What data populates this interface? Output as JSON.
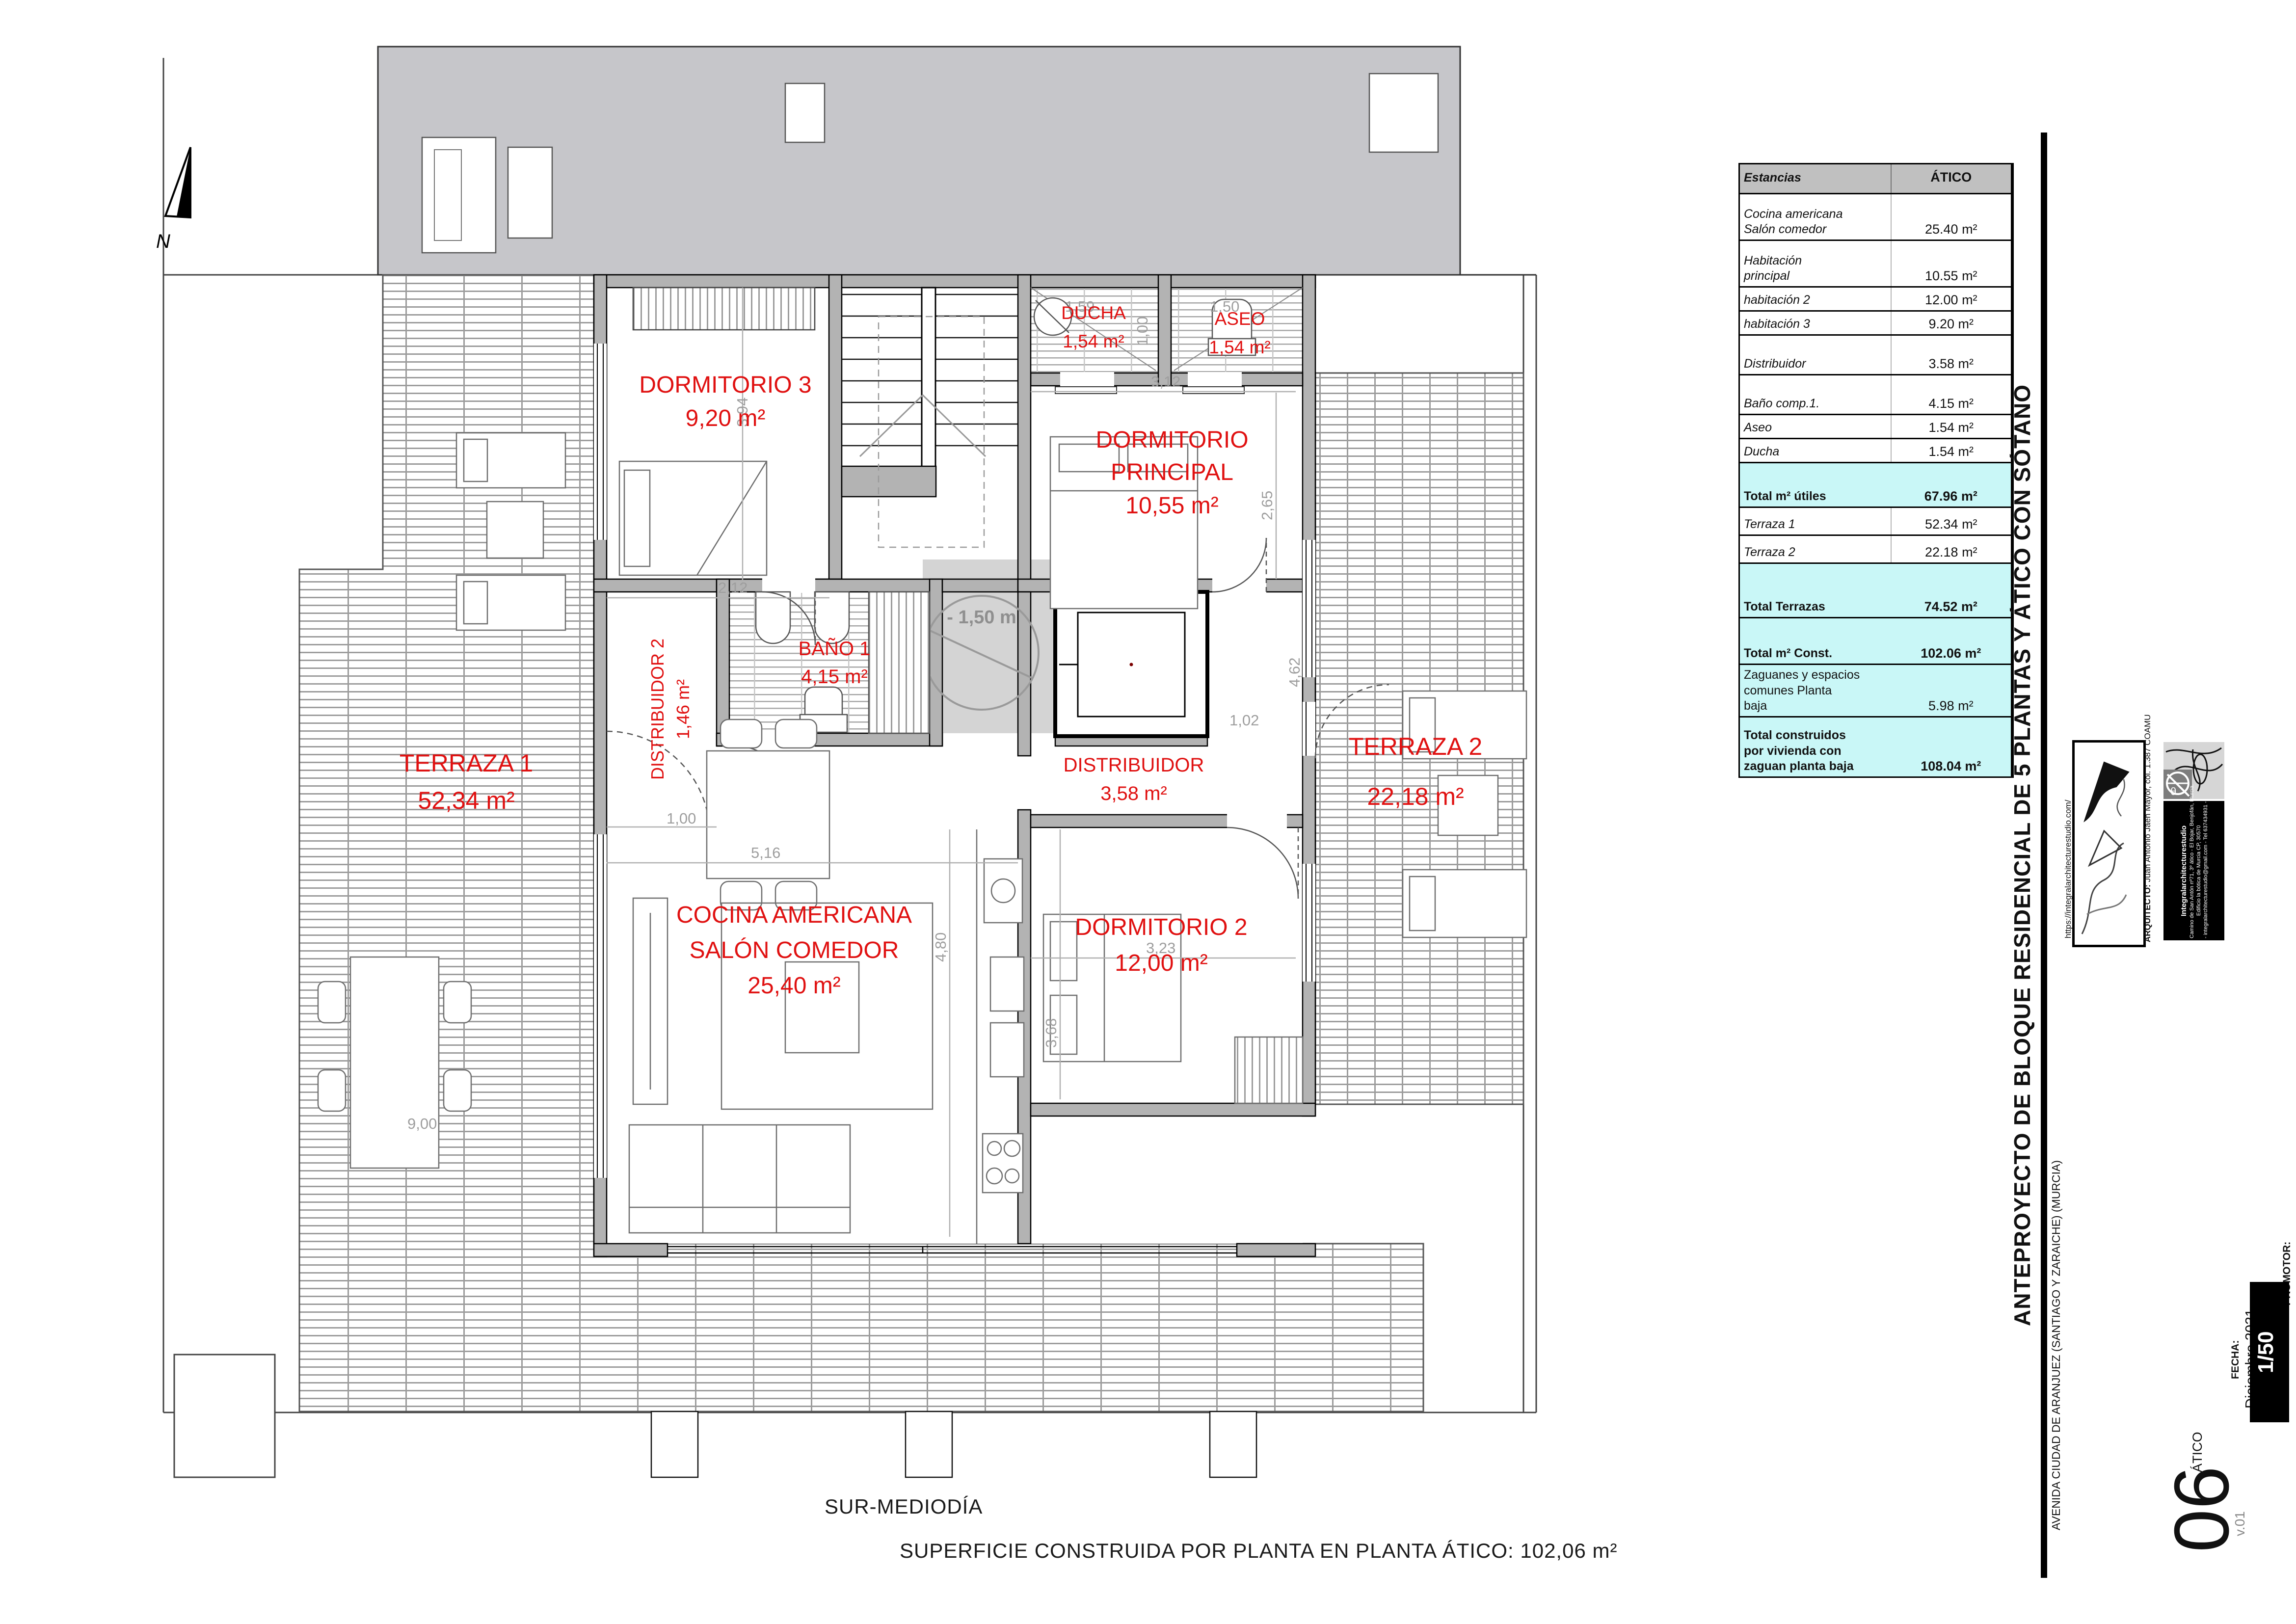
{
  "plan": {
    "annotations": {
      "turning_circle": "- 1,50 m",
      "north": "N"
    },
    "rooms": {
      "dorm3": {
        "name": "DORMITORIO 3",
        "area": "9,20 m²"
      },
      "ducha": {
        "name": "DUCHA",
        "area": "1,54 m²"
      },
      "aseo": {
        "name": "ASEO",
        "area": "1,54 m²"
      },
      "dorm_ppal": {
        "l1": "DORMITORIO",
        "l2": "PRINCIPAL",
        "area": "10,55 m²"
      },
      "distribuidor2": {
        "name": "DISTRIBUIDOR 2",
        "area": "1,46 m²"
      },
      "bano1": {
        "name": "BAÑO 1",
        "area": "4,15 m²"
      },
      "distribuidor": {
        "name": "DISTRIBUIDOR",
        "area": "3,58 m²"
      },
      "terraza1": {
        "name": "TERRAZA 1",
        "area": "52,34 m²"
      },
      "terraza2": {
        "name": "TERRAZA 2",
        "area": "22,18 m²"
      },
      "cocina": {
        "l1": "COCINA AMERICANA",
        "l2": "SALÓN COMEDOR",
        "area": "25,40 m²"
      },
      "dorm2": {
        "name": "DORMITORIO 2",
        "area": "12,00 m²"
      }
    },
    "dims": [
      {
        "t": "2,12"
      },
      {
        "t": "3,94"
      },
      {
        "t": "3,12"
      },
      {
        "t": "2,65"
      },
      {
        "t": "4,62"
      },
      {
        "t": "1,02"
      },
      {
        "t": "1,00"
      },
      {
        "t": "5,16"
      },
      {
        "t": "4,80"
      },
      {
        "t": "3,23"
      },
      {
        "t": "3,68"
      },
      {
        "t": "1,00"
      },
      {
        "t": "1,59"
      },
      {
        "t": "1,50"
      },
      {
        "t": "9,00"
      }
    ]
  },
  "table": {
    "header": {
      "label": "Estancias",
      "value": "ÁTICO"
    },
    "rows": [
      {
        "lines": [
          "Cocina americana",
          "Salón comedor"
        ],
        "value": "25.40 m²"
      },
      {
        "lines": [
          "Habitación",
          "principal"
        ],
        "value": "10.55 m²"
      },
      {
        "lines": [
          "habitación 2"
        ],
        "value": "12.00 m²"
      },
      {
        "lines": [
          "habitación 3"
        ],
        "value": "9.20 m²"
      },
      {
        "lines": [
          "Distribuidor"
        ],
        "value": "3.58 m²"
      },
      {
        "lines": [
          "Baño comp.1."
        ],
        "value": "4.15 m²"
      },
      {
        "lines": [
          "Aseo"
        ],
        "value": "1.54 m²"
      },
      {
        "lines": [
          "Ducha"
        ],
        "value": "1.54 m²"
      },
      {
        "lines": [
          "Total m² útiles"
        ],
        "value": "67.96 m²"
      },
      {
        "lines": [
          "Terraza 1"
        ],
        "value": "52.34 m²"
      },
      {
        "lines": [
          "Terraza 2"
        ],
        "value": "22.18 m²"
      },
      {
        "lines": [
          "Total Terrazas"
        ],
        "value": "74.52 m²"
      },
      {
        "lines": [
          "Total m² Const."
        ],
        "value": "102.06 m²"
      },
      {
        "lines": [
          "Zaguanes y espacios",
          "comunes Planta",
          "baja"
        ],
        "value": "5.98 m²"
      },
      {
        "lines": [
          "Total construidos",
          "por vivienda con",
          "zaguan planta baja"
        ],
        "value": "108.04 m²"
      }
    ]
  },
  "titleblock": {
    "title": "ANTEPROYECTO DE BLOQUE RESIDENCIAL DE 5 PLANTAS Y ÁTICO CON SÓTANO",
    "address": "AVENIDA CIUDAD DE ARANJUEZ (SANTIAGO Y ZARAICHE) (MURCIA)",
    "url": "https://integralarchitecturestudio.com/",
    "architect_label": "ARQUITECTO:",
    "architect": " Juan Antonio Jaén Mayor, col. 1.387 COAMU",
    "studio_name": "Integralarchitecturestudio",
    "studio_line1": "Camino de San Antón nº71, 3º ático - El Bojar, Benjofán, Murcia.",
    "studio_line2": "Edificio la bótica de Murcia CP, 30570",
    "studio_line3": "- integralarchitecturestudio@gmail.com - Tel 637434931 -",
    "fecha_label": "FECHA:",
    "fecha": "Diciembre  2021",
    "promotor_label": "PROMOTOR:",
    "scale": "1/50",
    "version": "v.01",
    "sheet_name": "ÁTICO",
    "sheet_number": "06"
  },
  "footer": {
    "orientation": "SUR-MEDIODÍA",
    "area_note": "SUPERFICIE CONSTRUIDA POR PLANTA EN PLANTA ÁTICO: 102,06 m²"
  },
  "colors": {
    "label_red": "#e01111",
    "terrace_hatch": "#9c9c9c",
    "wall_gray": "#b3b3b3",
    "total_cyan": "#c9f7f7"
  }
}
